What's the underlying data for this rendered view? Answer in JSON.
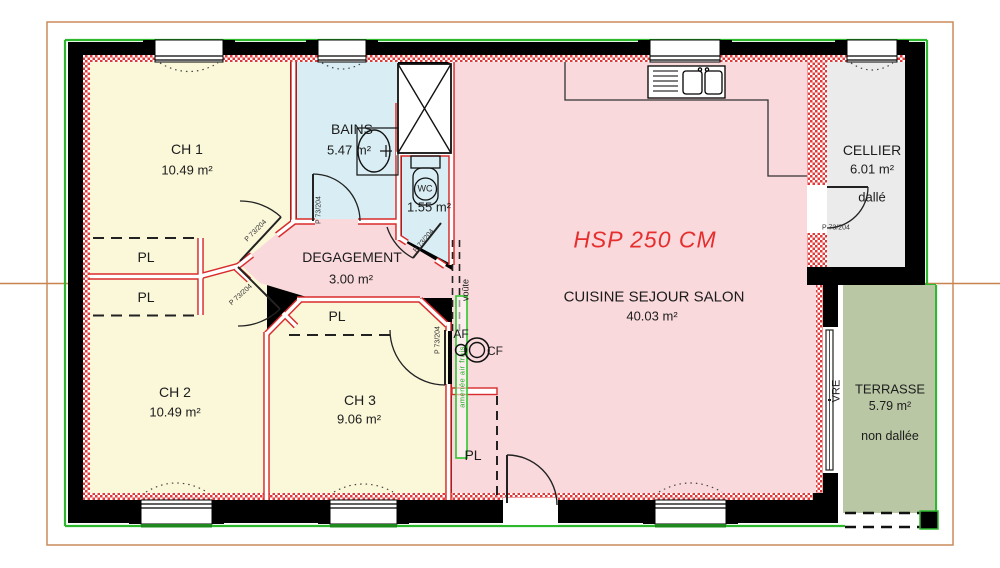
{
  "plan": {
    "rooms": {
      "ch1": {
        "name": "CH 1",
        "area": "10.49 m²"
      },
      "ch2": {
        "name": "CH 2",
        "area": "10.49 m²"
      },
      "ch3": {
        "name": "CH 3",
        "area": "9.06 m²"
      },
      "bains": {
        "name": "BAINS",
        "area": "5.47 m²"
      },
      "wc": {
        "name": "WC",
        "area": "1.55 m²"
      },
      "degagement": {
        "name": "DEGAGEMENT",
        "area": "3.00 m²"
      },
      "cuisine": {
        "name": "CUISINE SEJOUR SALON",
        "area": "40.03 m²"
      },
      "cellier": {
        "name": "CELLIER",
        "area": "6.01 m²",
        "note": "dallé"
      },
      "terrasse": {
        "name": "TERRASSE",
        "area": "5.79 m²",
        "note": "non dallée"
      }
    },
    "annotations": {
      "ceiling_height": "HSP 250 CM",
      "closet": "PL",
      "arch": "voûte",
      "sliding_bay": "VRE",
      "cold_water": "AF",
      "meter": "CF",
      "air_inlet": "amenée air frais",
      "door_size": "P 73/204",
      "wc_fixture": "WC"
    },
    "colors": {
      "bedroom": "#fbf7d9",
      "bath": "#d9eef4",
      "living": "#f9d9db",
      "cellier": "#ebebeb",
      "terrasse": "#b9c7a5",
      "wall": "#000000",
      "red_wall": "#d92b2b",
      "frame_orange": "#c8834f",
      "accent_green": "#2db82d",
      "hsp_red": "#e62e2e"
    }
  }
}
